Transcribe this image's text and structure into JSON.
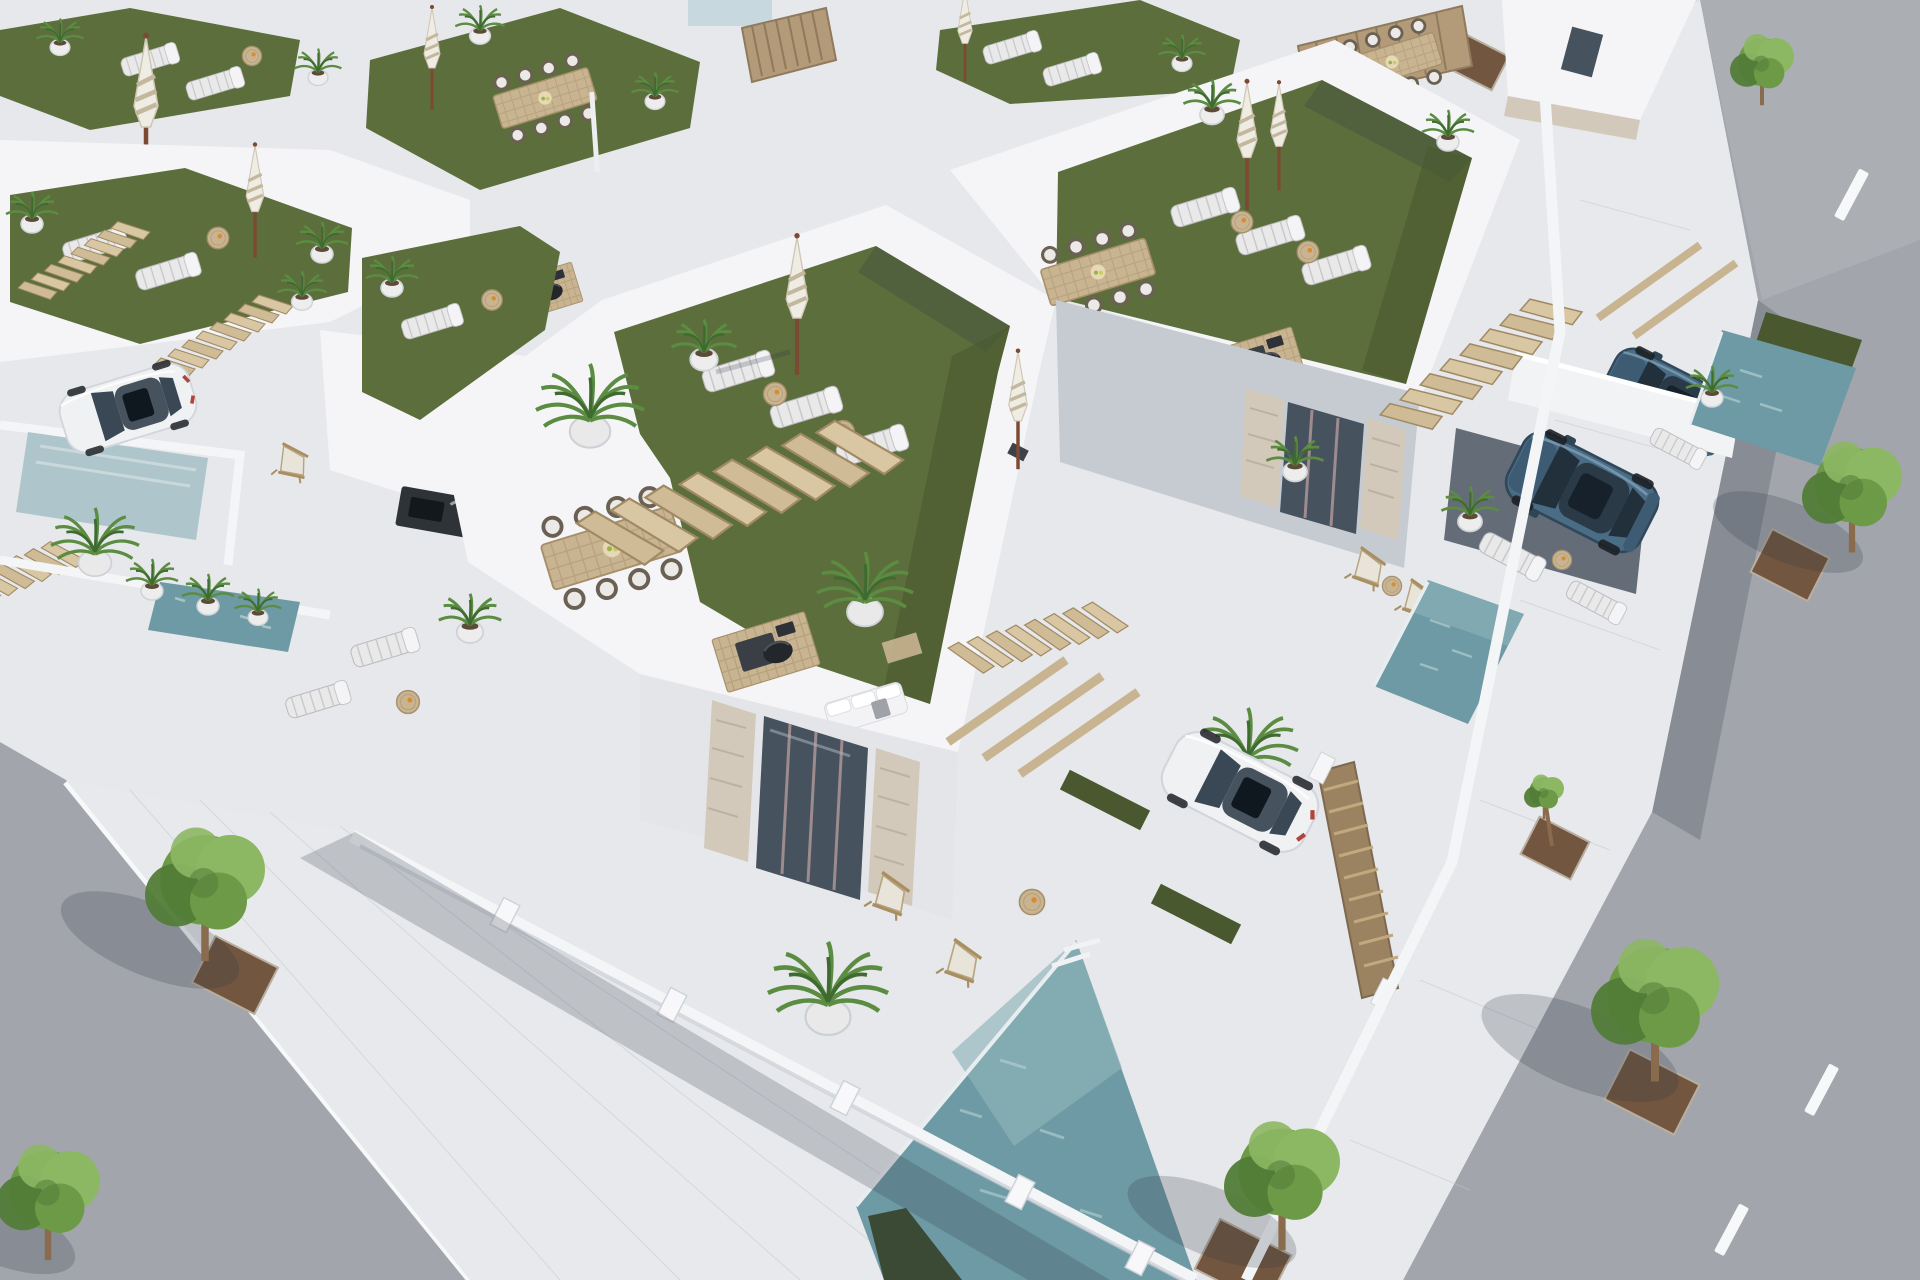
{
  "scene": {
    "type": "3d-architectural-render",
    "view": "high-angle-aerial",
    "subject": "modern-white-villa-development-with-rooftop-terraces",
    "sky_visible": false,
    "daylight": "bright-sun-shadows-to-lower-left"
  },
  "palette": {
    "paver": "#dcdee1",
    "paverBright": "#e7e9ec",
    "paverLine": "#c3c7cc",
    "asphalt": "#a2a6ac",
    "asphaltLight": "#b3b6bb",
    "lineWhite": "#f7f8f9",
    "whiteLit": "#f5f5f7",
    "whiteShade": "#e3e5e9",
    "wallSide": "#c6cbd2",
    "wallDark": "#aab0b9",
    "carportShade": "#646c77",
    "turf": "#5c6e3c",
    "turfShade": "#49582f",
    "turfBright": "#687c43",
    "poolMid": "#6d9aa4",
    "poolLight": "#8fb4ba",
    "poolPale": "#aec6cb",
    "poolDark": "#39462e",
    "wood": "#c9b491",
    "woodDark": "#a6906c",
    "stone": "#d3c9bb",
    "glassDark": "#46525e",
    "frameMauve": "#9d8b8d",
    "carBlue": "#4a6c85",
    "carBlueDark": "#31485a",
    "carWhite": "#eff1f3",
    "glassCar": "#2a3a47",
    "treeLight": "#8cb763",
    "treeMid": "#6d9a47",
    "treeDark": "#527c38",
    "palmGreen": "#5b8c41",
    "palmDark": "#3f6b30",
    "trunk": "#8a6b4e",
    "soil": "#73563f",
    "umbBeige": "#c3b79e",
    "loungerPad": "#e9e9ea",
    "shadowC": "rgba(45,55,70,0.22)"
  },
  "objects": {
    "foreground_villas": 2,
    "background_roof_terraces": 6,
    "rooftop_lawns": 7,
    "sun_loungers": 16,
    "closed_parasols": 8,
    "dining_sets": 4,
    "potted_palms": 20,
    "pools": 5,
    "deck_chairs": 6,
    "cars": {
      "white_sedan": 1,
      "white_coupe": 1,
      "blue_suv": 2
    },
    "street_trees": 6,
    "tree_pits": 6,
    "stair_flights": 6,
    "wood_deck_pads": 4,
    "pergola_beam_groups": 2,
    "roads": 2,
    "road_marking": "white-dashed-lane-lines",
    "fences": {
      "wood_slat_panels": 3
    }
  }
}
